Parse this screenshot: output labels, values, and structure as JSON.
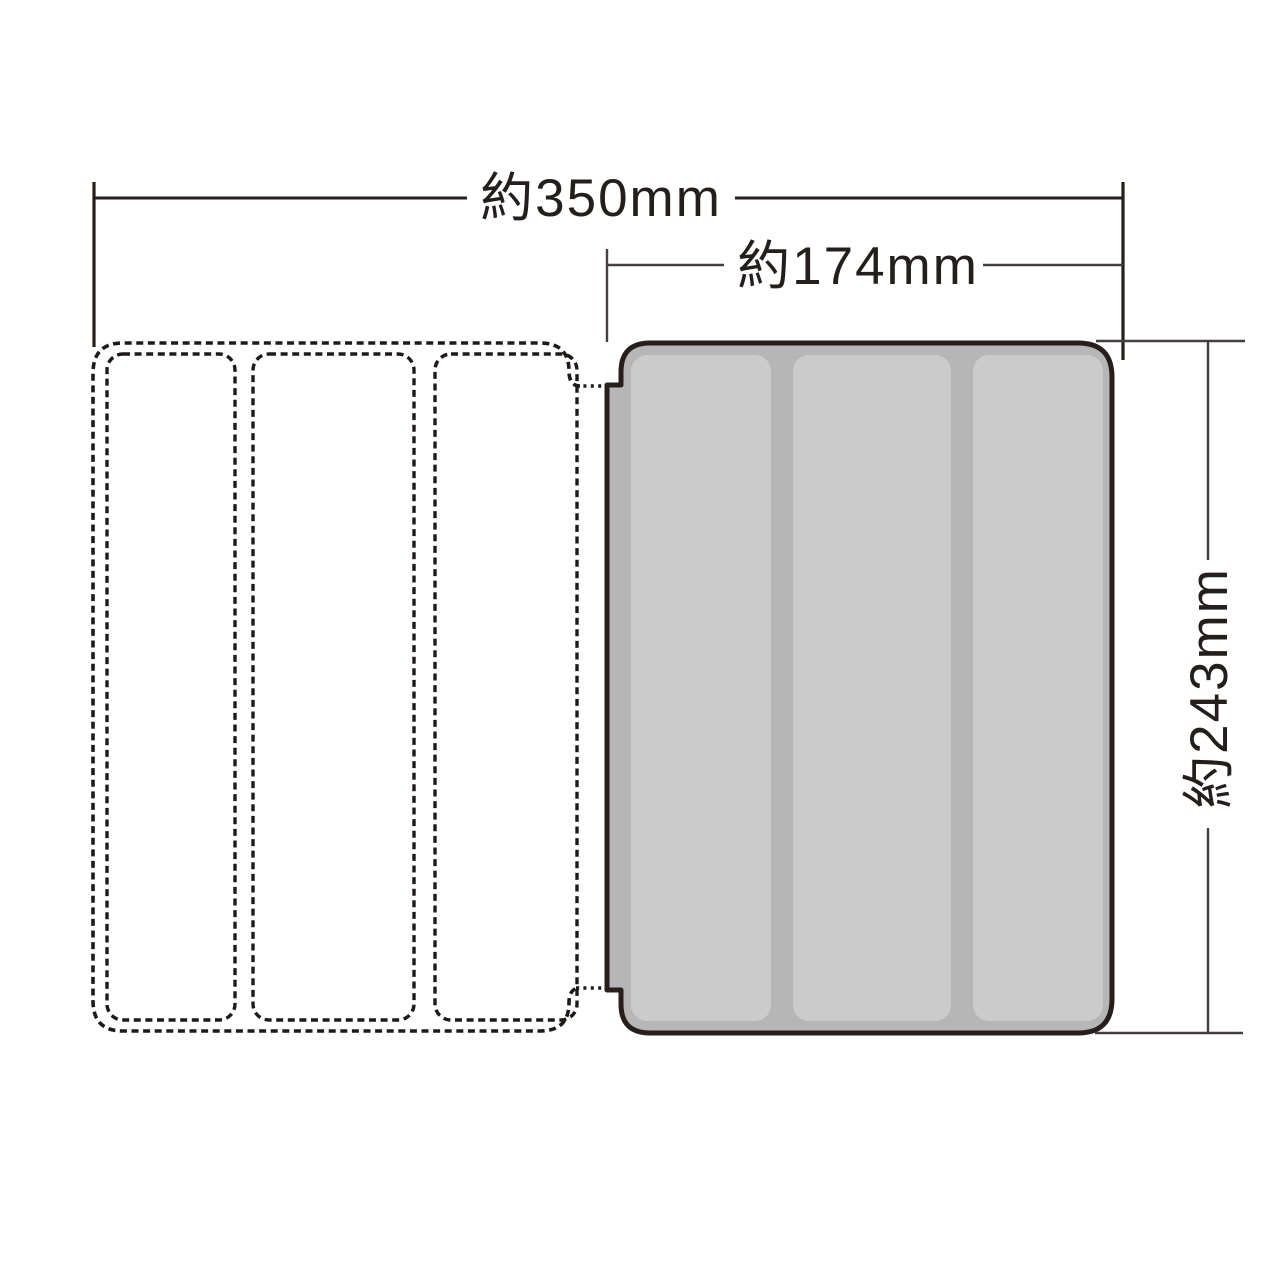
{
  "page": {
    "background": "#ffffff",
    "type": "product-dimension-diagram"
  },
  "dimensions": {
    "total_width": {
      "label": "約350mm",
      "value_mm": 350
    },
    "case_width": {
      "label": "約174mm",
      "value_mm": 174
    },
    "case_height": {
      "label": "約243mm",
      "value_mm": 243
    }
  },
  "styles": {
    "outline_color": "#281f1c",
    "dashed_line_color": "#1f1a18",
    "dim_line_color": "#463f3c",
    "text_color": "#241e1c",
    "case_fill": "#b6b6b6",
    "case_panel_fill": "#cbcbcb"
  },
  "parts": {
    "cover_open": {
      "panel_count": 3
    },
    "case_closed": {
      "panel_count": 3
    }
  }
}
